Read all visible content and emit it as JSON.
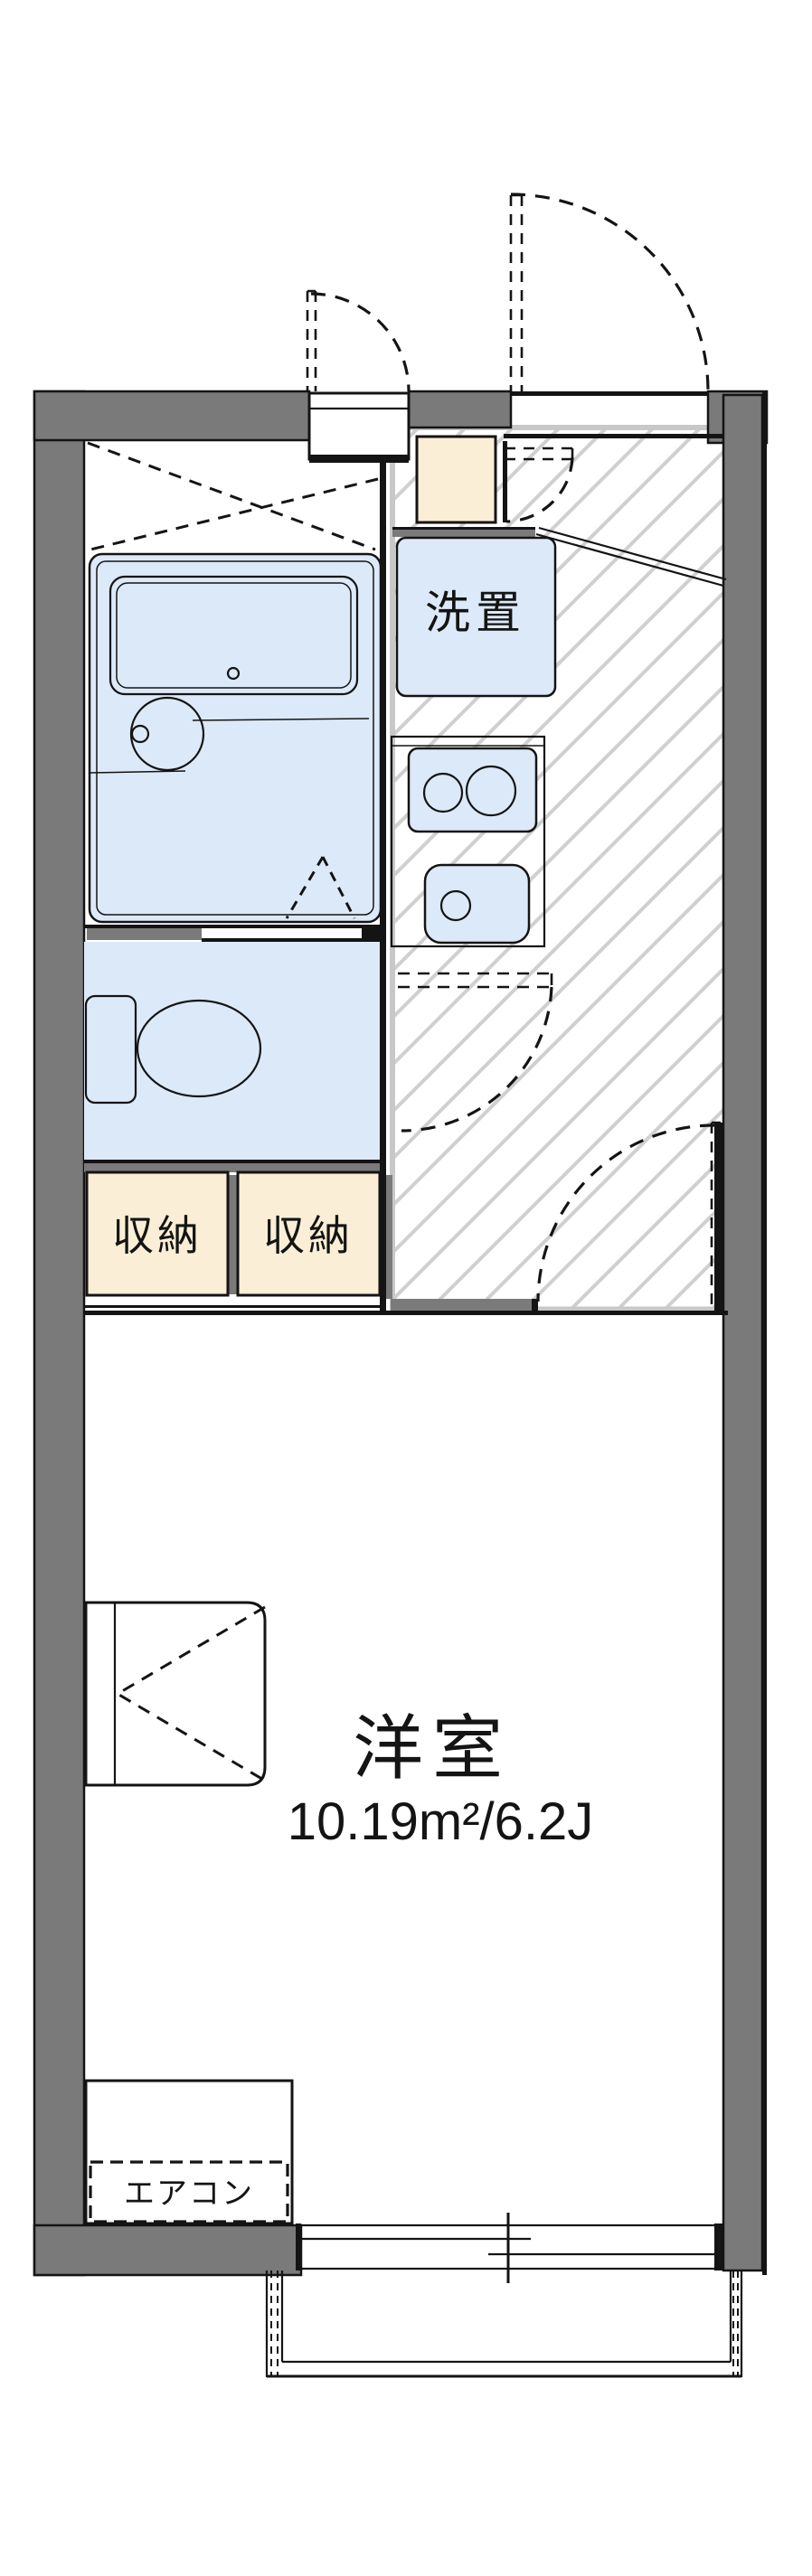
{
  "floorplan": {
    "labels": {
      "laundry": "洗置",
      "storage_left": "収納",
      "storage_right": "収納",
      "room_name": "洋室",
      "room_area": "10.19m²/6.2J",
      "aircon": "エアコン"
    },
    "colors": {
      "wall": "#7a7a7a",
      "line": "#141414",
      "fixture": "#dce9f8",
      "storage": "#faeed6",
      "silver": "#c8c8c8",
      "hatch": "#d0d0d0",
      "bg": "#ffffff"
    }
  }
}
